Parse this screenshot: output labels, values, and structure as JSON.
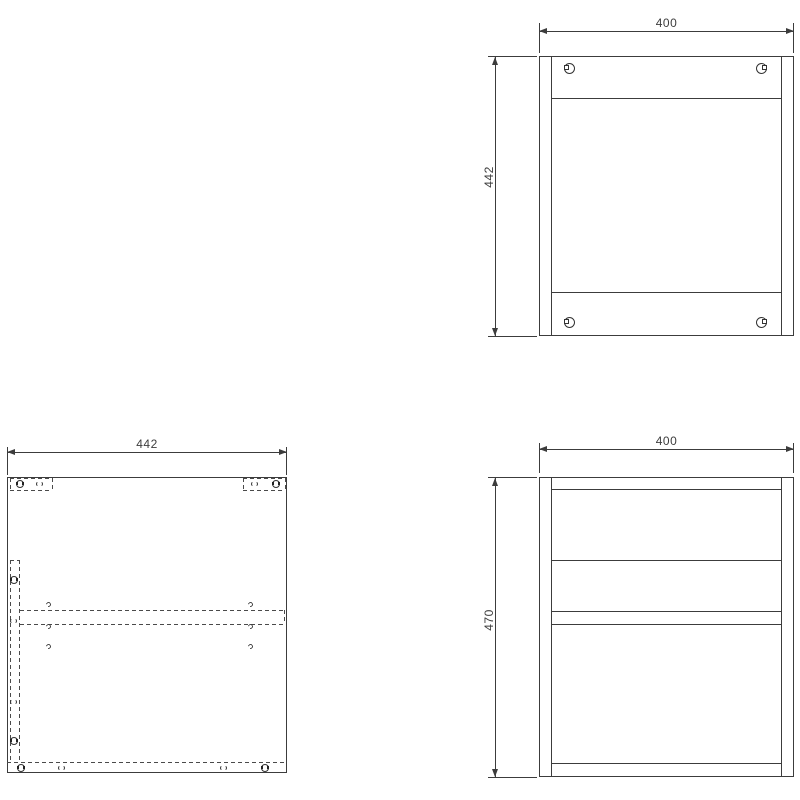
{
  "drawing": {
    "background": "#ffffff",
    "line_color": "#3c3c3c",
    "dash_color": "#4a4a4a",
    "views": {
      "front": {
        "width_dim": "400",
        "height_dim": "442"
      },
      "plan": {
        "width_dim": "442"
      },
      "side": {
        "width_dim": "400",
        "height_dim": "470"
      }
    },
    "icons": {
      "cam_lock_front": "circle with square notch (cam fitting, front view)",
      "cam_lock_top": "circle with dark side slots (cam fitting, top view)",
      "hole": "small open circle (fitting hole)",
      "dowel": "tiny arc (dowel hole)"
    }
  }
}
